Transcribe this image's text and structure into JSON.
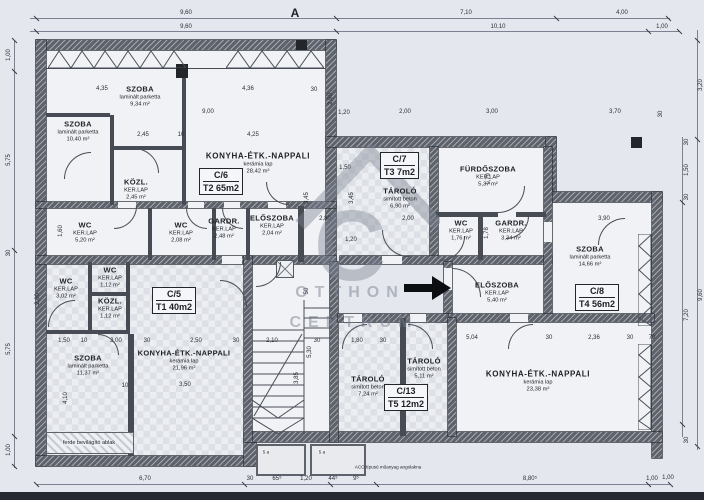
{
  "meta": {
    "section_marker": "A"
  },
  "watermark": {
    "logo": "C",
    "line1": "OTTHON",
    "line2": "CENTRUM"
  },
  "units": [
    {
      "id": "C/6",
      "size": "T2 65m2"
    },
    {
      "id": "C/7",
      "size": "T3 7m2"
    },
    {
      "id": "C/5",
      "size": "T1 40m2"
    },
    {
      "id": "C/8",
      "size": "T4 56m2"
    },
    {
      "id": "C/13",
      "size": "T5 12m2"
    }
  ],
  "rooms": [
    {
      "n": "SZOBA",
      "f": "laminált parketta",
      "a": "10,40 m²"
    },
    {
      "n": "SZOBA",
      "f": "laminált parketta",
      "a": "9,34 m²"
    },
    {
      "n": "KÖZL.",
      "f": "KER.LAP",
      "a": "2,45 m²"
    },
    {
      "n": "KONYHA-ÉTK.-NAPPALI",
      "f": "kerámia lap",
      "a": "28,42 m²"
    },
    {
      "n": "WC",
      "f": "KER.LAP",
      "a": "5,20 m²"
    },
    {
      "n": "WC",
      "f": "KER.LAP",
      "a": "2,08 m²"
    },
    {
      "n": "GARDR.",
      "f": "KER.LAP",
      "a": "2,48 m²"
    },
    {
      "n": "ELŐSZOBA",
      "f": "KER.LAP",
      "a": "2,04 m²"
    },
    {
      "n": "TÁROLÓ",
      "f": "simított beton",
      "a": "6,90 m²"
    },
    {
      "n": "FÜRDŐSZOBA",
      "f": "KER.LAP",
      "a": "5,37 m²"
    },
    {
      "n": "WC",
      "f": "KER.LAP",
      "a": "1,76 m²"
    },
    {
      "n": "GARDR.",
      "f": "KER.LAP",
      "a": "3,34 m²"
    },
    {
      "n": "SZOBA",
      "f": "laminált parketta",
      "a": "14,66 m²"
    },
    {
      "n": "ELŐSZOBA",
      "f": "KER.LAP",
      "a": "5,40 m²"
    },
    {
      "n": "KONYHA-ÉTK.-NAPPALI",
      "f": "kerámia lap",
      "a": "23,38 m²"
    },
    {
      "n": "WC",
      "f": "KER.LAP",
      "a": "3,02 m²"
    },
    {
      "n": "WC",
      "f": "KER.LAP",
      "a": "1,12 m²"
    },
    {
      "n": "KÖZL.",
      "f": "KER.LAP",
      "a": "1,12 m²"
    },
    {
      "n": "SZOBA",
      "f": "laminált parketta",
      "a": "11,37 m²"
    },
    {
      "n": "KONYHA-ÉTK.-NAPPALI",
      "f": "kerámia lap",
      "a": "21,96 m²"
    },
    {
      "n": "TÁROLÓ",
      "f": "simított beton",
      "a": "7,24 m²"
    },
    {
      "n": "TÁROLÓ",
      "f": "simított beton",
      "a": "5,11 m²"
    }
  ],
  "notes": {
    "skylight": "ferde bevilágító ablak",
    "drain": "ACO típusú műanyag angolakna",
    "stoop": "5 a"
  },
  "dims": [
    "9,60",
    "7,10",
    "4,00",
    "9,60",
    "10,10",
    "1,00",
    "1,00",
    "5,75",
    "30",
    "5,75",
    "1,00",
    "3,20",
    "9,60",
    "30",
    "1,50",
    "30",
    "7,20",
    "30",
    "1,00",
    "6,70",
    "30",
    "65⁵",
    "1,20",
    "44⁵",
    "9⁵",
    "8,80⁵",
    "1,00",
    "4,35",
    "4,36",
    "30",
    "2,90",
    "9,00",
    "2,00",
    "3,00",
    "3,70",
    "30",
    "2,45",
    "10",
    "4,25",
    "1,20",
    "1,50",
    "3,45",
    "3,45",
    "2,80",
    "2,00",
    "1,20",
    "3,90",
    "1,50",
    "10",
    "2,00",
    "30",
    "2,50",
    "30",
    "2,10",
    "30",
    "1,80",
    "30",
    "5,04",
    "30",
    "2,36",
    "30",
    "70",
    "4,10",
    "2,00",
    "1,60",
    "3,85",
    "5,30",
    "50",
    "1,79",
    "1,78",
    "3,50",
    "10"
  ]
}
